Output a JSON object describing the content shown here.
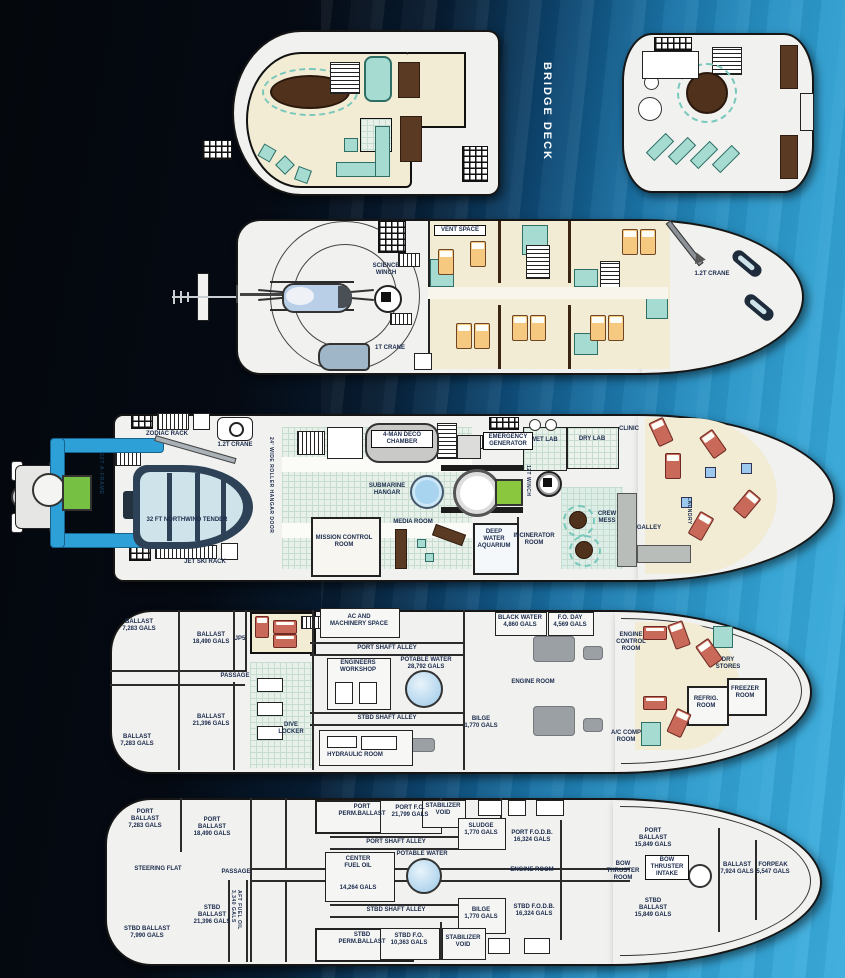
{
  "page": {
    "bridge_deck": "BRIDGE DECK"
  },
  "d2": {
    "vent_space": "VENT SPACE",
    "science_winch": "SCIENCE\nWINCH",
    "crane_1t": "1T CRANE",
    "crane_12t": "1.2T CRANE"
  },
  "d3": {
    "zodiac_rack": "ZODIAC RACK",
    "crane_12t": "1.2T CRANE",
    "a_frame": "22T A-FRAME",
    "hangar_door": "24' WIDE ROLLER HANGAR DOOR",
    "tender": "32 FT NORTHWIND TENDER",
    "jet_ski_rack": "JET SKI RACK",
    "deco_chamber": "4-MAN DECO\nCHAMBER",
    "submarine_hangar": "SUBMARINE\nHANGAR",
    "media_room": "MEDIA ROOM",
    "mission_control": "MISSION CONTROL\nROOM",
    "emergency_generator": "EMERGENCY\nGENERATOR",
    "wet_lab": "WET LAB",
    "dry_lab": "DRY LAB",
    "clinic": "CLINIC",
    "winch_12t": "12T WINCH",
    "deep_water_aquarium": "DEEP\nWATER\nAQUARIUM",
    "incinerator_room": "INCINERATOR\nROOM",
    "crew_mess": "CREW\nMESS",
    "galley": "GALLEY",
    "laundry": "LAUNDRY"
  },
  "d4": {
    "ballast_7283_top": "BALLAST\n7,283 GALS",
    "ballast_18490": "BALLAST\n18,490 GALS",
    "jp5": "JP5",
    "passage": "PASSAGE",
    "ballast_21396": "BALLAST\n21,396 GALS",
    "ballast_7283_bottom": "BALLAST\n7,283 GALS",
    "dive_locker": "DIVE\nLOCKER",
    "ac_machinery": "AC AND\nMACHINERY SPACE",
    "port_shaft_alley": "PORT SHAFT ALLEY",
    "engineers_workshop": "ENGINEERS\nWORKSHOP",
    "potable_water": "POTABLE WATER\n28,792 GALS",
    "stbd_shaft_alley": "STBD SHAFT ALLEY",
    "hydraulic_room": "HYDRAULIC ROOM",
    "bilge": "BILGE\n1,770 GALS",
    "engine_room": "ENGINE ROOM",
    "black_water": "BLACK WATER\n4,860 GALS",
    "fo_day": "F.O. DAY\n4,569 GALS",
    "engine_control": "ENGINE\nCONTROL\nROOM",
    "dry_stores": "DRY\nSTORES",
    "refrig_room": "REFRIG.\nROOM",
    "freezer_room": "FREEZER\nROOM",
    "ac_comp_room": "A/C COMP\nROOM"
  },
  "d5": {
    "port_ballast_7283": "PORT BALLAST\n7,283 GALS",
    "port_ballast_18490": "PORT\nBALLAST\n18,490 GALS",
    "steering_flat": "STEERING FLAT",
    "passage": "PASSAGE",
    "stbd_ballast_21396": "STBD\nBALLAST\n21,396 GALS",
    "aft_fuel_oil": "AFT FUEL OIL\n3,340 GALS",
    "stbd_ballast_7990": "STBD BALLAST\n7,990 GALS",
    "port_perm_ballast": "PORT\nPERM.BALLAST",
    "port_shaft_alley": "PORT SHAFT ALLEY",
    "center_fuel_oil": "CENTER\nFUEL OIL",
    "center_fuel_oil_gals": "14,264 GALS",
    "stbd_shaft_alley": "STBD SHAFT ALLEY",
    "stbd_perm_ballast": "STBD\nPERM.BALLAST",
    "port_fo": "PORT F.O.\n21,799 GALS",
    "stabilizer_void_top": "STABILIZER\nVOID",
    "sludge": "SLUDGE\n1,770 GALS",
    "port_fodb": "PORT F.O.D.B.\n16,324 GALS",
    "potable_water": "POTABLE WATER",
    "engine_room": "ENGINE ROOM",
    "bilge": "BILGE\n1,770 GALS",
    "stbd_fodb": "STBD F.O.D.B.\n16,324 GALS",
    "stbd_fo": "STBD F.O.\n10,363 GALS",
    "stabilizer_void_bottom": "STABILIZER\nVOID",
    "bow_thruster_room": "BOW\nTHRUSTER\nROOM",
    "bow_thruster_intake": "BOW\nTHRUSTER\nINTAKE",
    "port_ballast_15849": "PORT\nBALLAST\n15,849 GALS",
    "stbd_ballast_15849": "STBD\nBALLAST\n15,849 GALS",
    "ballast_7924": "BALLAST\n7,924 GALS",
    "forpeak": "FORPEAK\n5,547 GALS"
  }
}
